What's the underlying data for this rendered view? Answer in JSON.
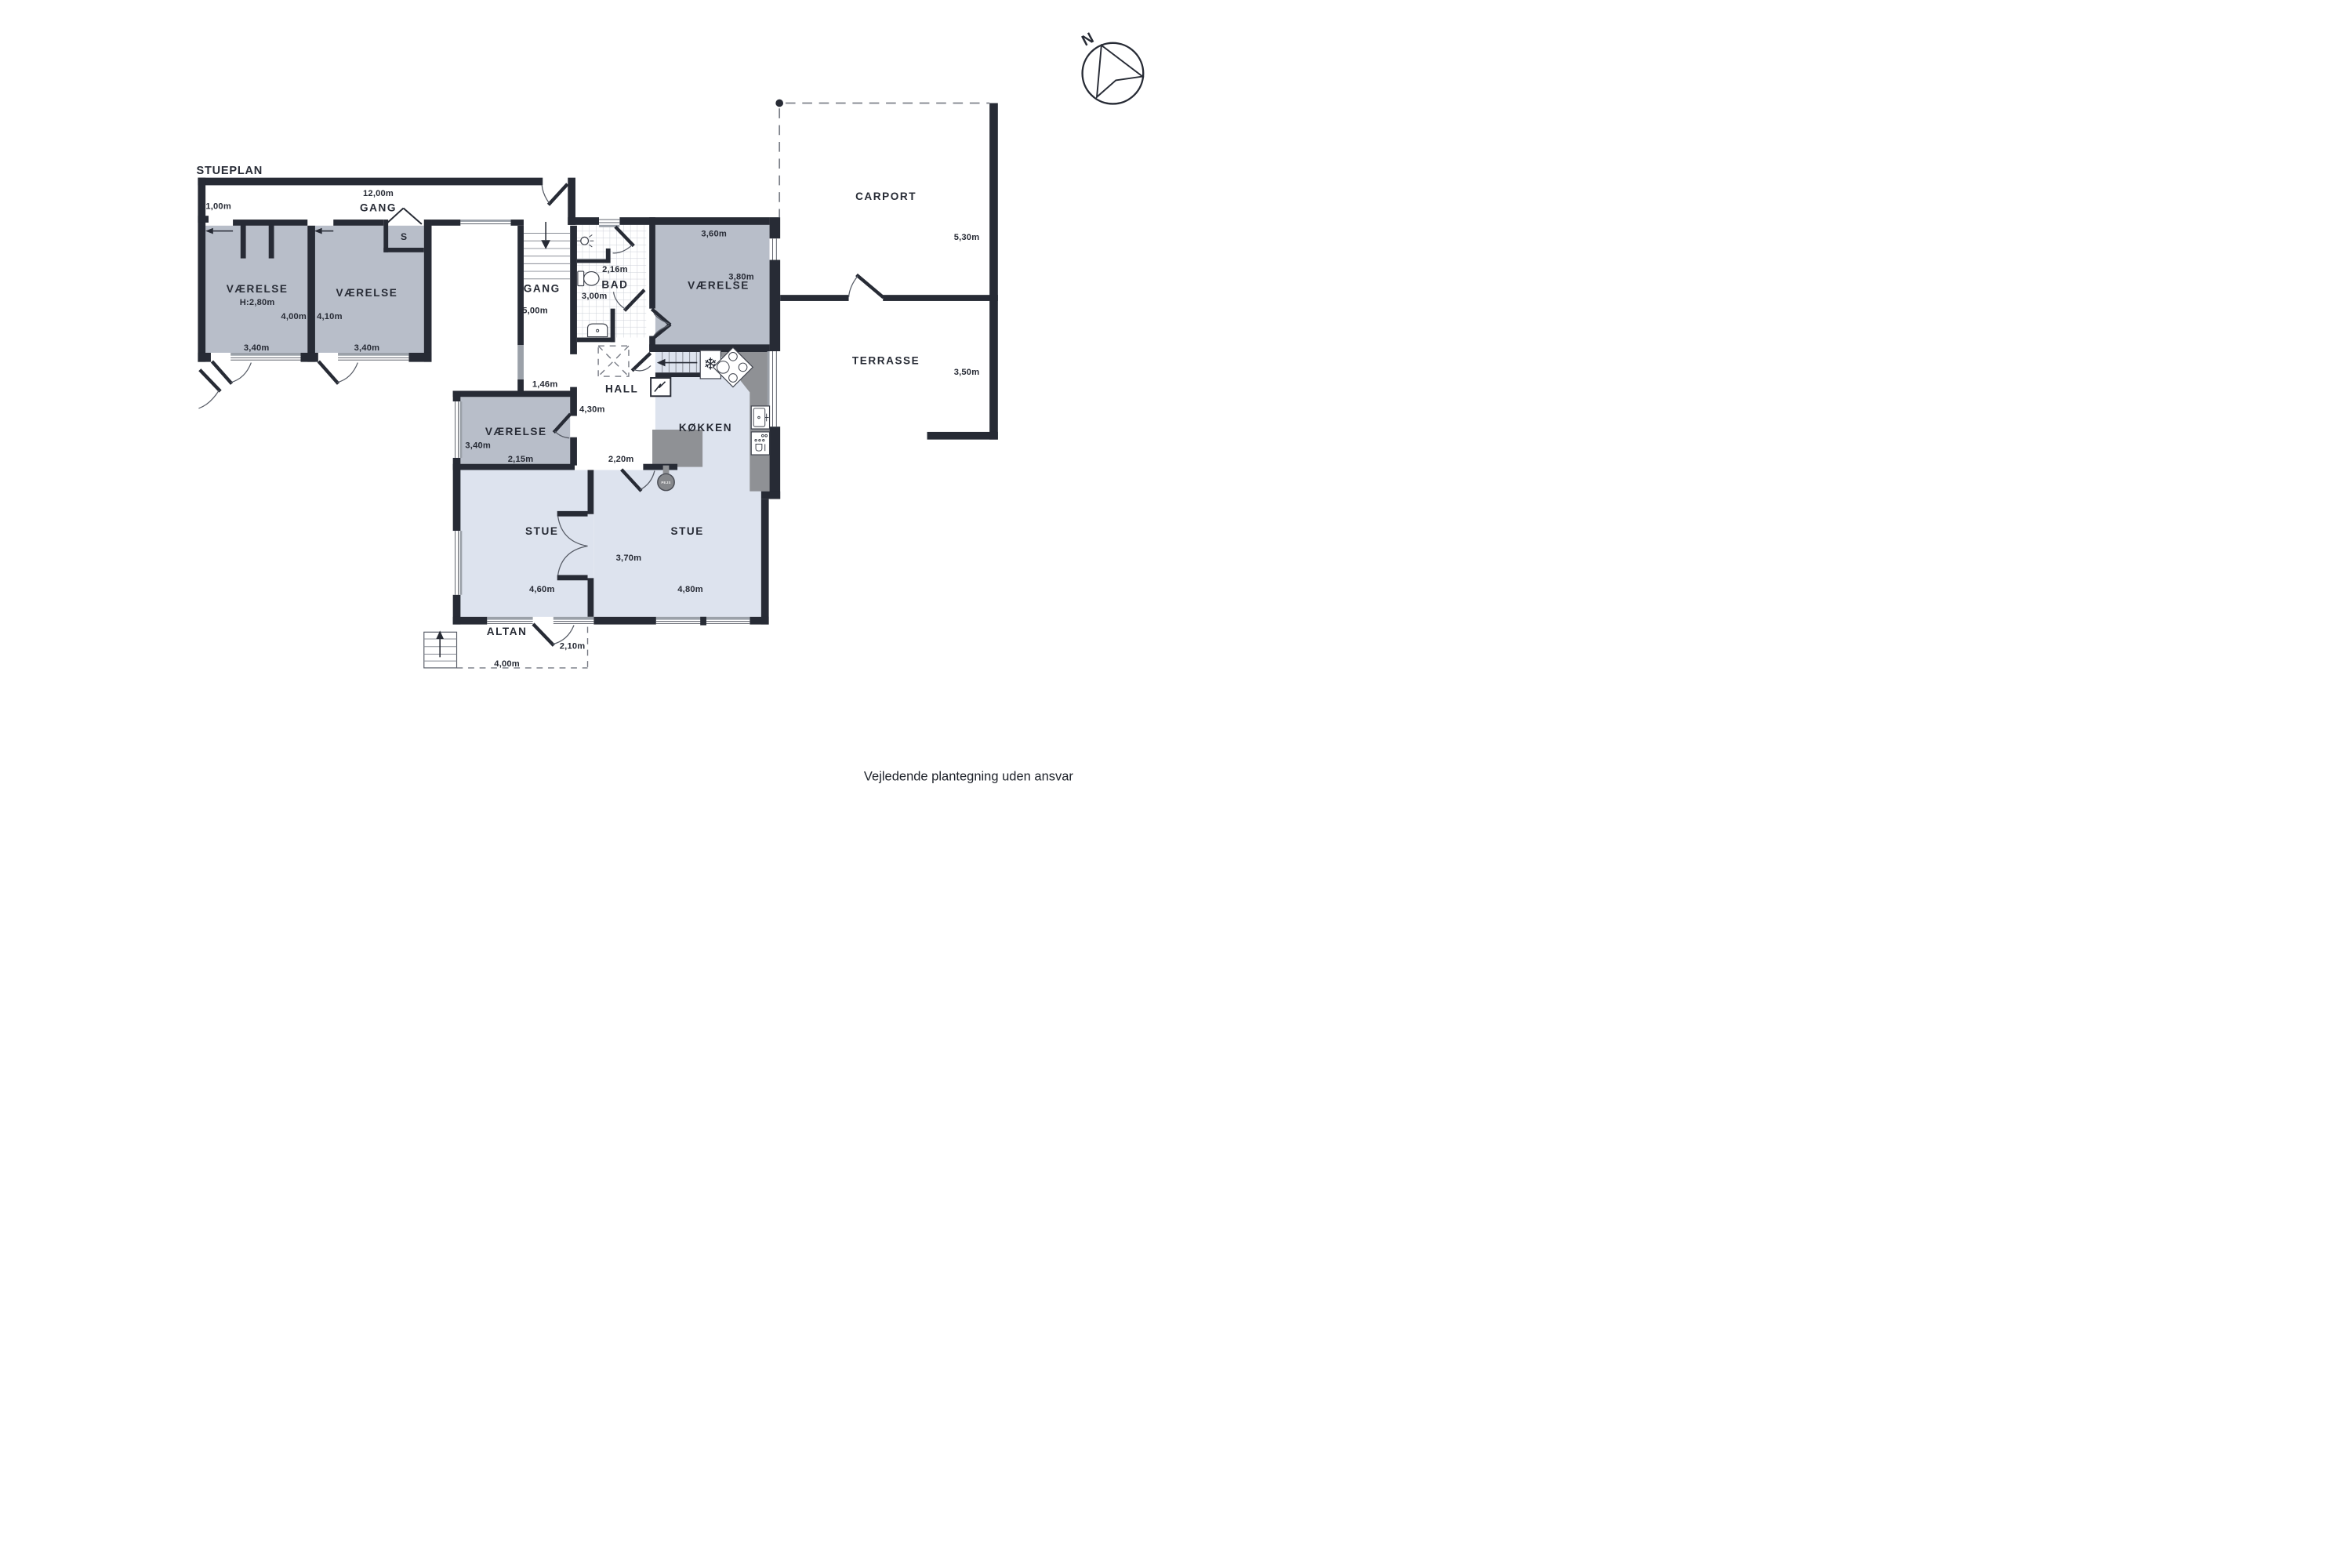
{
  "plan": {
    "title": "STUEPLAN",
    "footer": "Vejledende plantegning uden ansvar",
    "compass": {
      "north": "N"
    },
    "colors": {
      "wall": "#272b35",
      "bedroom_floor": "#b8bec9",
      "living_floor": "#dde3ee",
      "counter": "#8f9195",
      "background": "#ffffff"
    },
    "rooms": {
      "gang_wing": {
        "name": "GANG",
        "width": "12,00m",
        "wall_left": "1,00m"
      },
      "vaerelse_1": {
        "name": "VÆRELSE",
        "ceiling": "H:2,80m",
        "depth": "4,00m",
        "width": "3,40m"
      },
      "vaerelse_2": {
        "name": "VÆRELSE",
        "depth": "4,10m",
        "width": "3,40m"
      },
      "closet": {
        "label": "S"
      },
      "gang_mid": {
        "name": "GANG",
        "length": "5,00m",
        "passage": "1,46m"
      },
      "bad": {
        "name": "BAD",
        "width": "2,16m",
        "length": "3,00m"
      },
      "vaerelse_3": {
        "name": "VÆRELSE",
        "depth": "3,40m",
        "width": "2,15m"
      },
      "vaerelse_4": {
        "name": "VÆRELSE",
        "width": "3,60m",
        "depth": "3,80m"
      },
      "hall": {
        "name": "HALL",
        "length": "4,30m",
        "opening": "2,20m"
      },
      "koekken": {
        "name": "KØKKEN"
      },
      "stue_left": {
        "name": "STUE",
        "width": "4,60m"
      },
      "stue_right": {
        "name": "STUE",
        "width": "4,80m",
        "depth": "3,70m"
      },
      "carport": {
        "name": "CARPORT",
        "depth": "5,30m"
      },
      "terrasse": {
        "name": "TERRASSE",
        "depth": "3,50m"
      },
      "altan": {
        "name": "ALTAN",
        "width": "4,00m",
        "depth": "2,10m"
      },
      "pejs": {
        "label": "PEJS"
      }
    }
  }
}
